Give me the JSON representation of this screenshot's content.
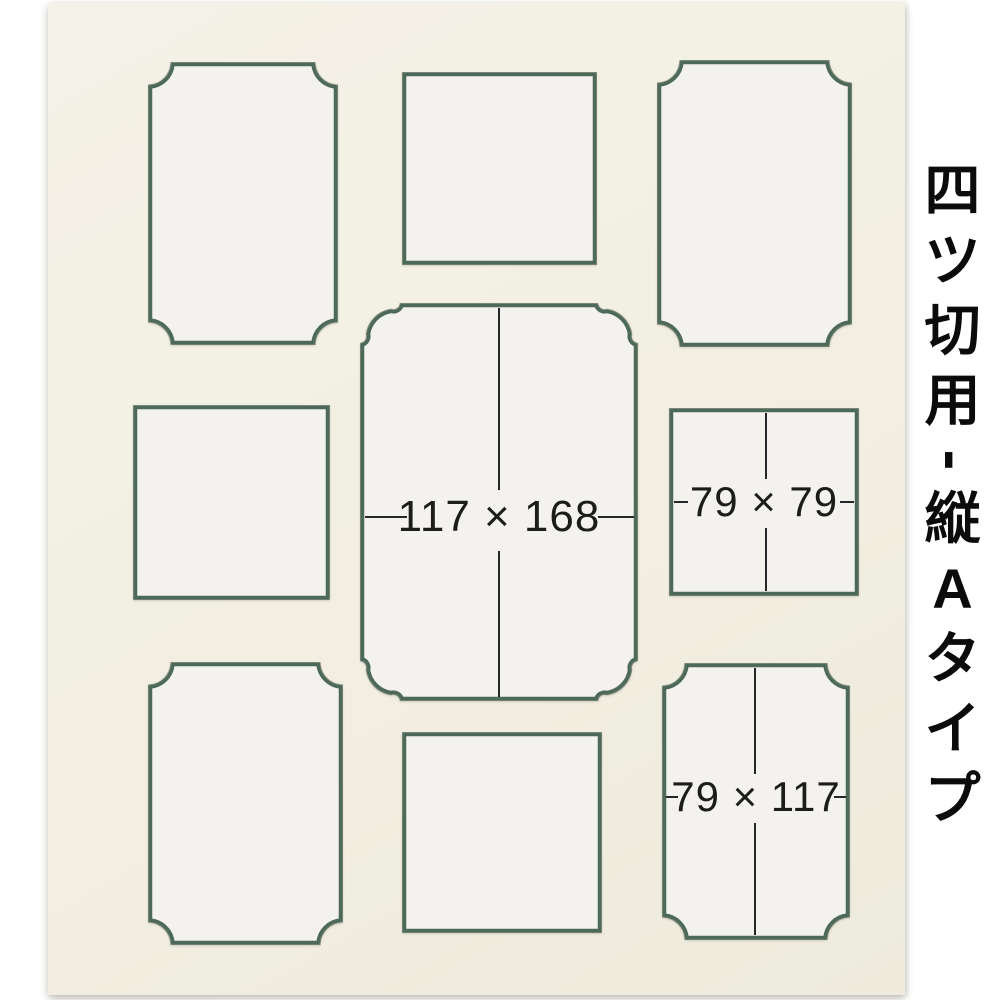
{
  "page": {
    "background": "#ffffff"
  },
  "product": {
    "description": "multi-window photo mat board, cream with dark green bevel core",
    "mat_color": "#f2efe2",
    "core_color": "#4d6a59",
    "opening_fill": "#f4f2ee",
    "dimension_line_color": "#26262a",
    "side_label": {
      "text": "四ツ切用-縦Aタイプ",
      "chars": [
        "四",
        "ツ",
        "切",
        "用",
        "-",
        "縦",
        "A",
        "タ",
        "イ",
        "プ"
      ]
    }
  },
  "openings": [
    {
      "position": "top-left",
      "corner_style": "notched",
      "label": ""
    },
    {
      "position": "top-center",
      "corner_style": "square",
      "label": ""
    },
    {
      "position": "top-right",
      "corner_style": "notched",
      "label": ""
    },
    {
      "position": "middle-left",
      "corner_style": "square",
      "label": ""
    },
    {
      "position": "center",
      "corner_style": "decorative-rounded",
      "label": "117 × 168"
    },
    {
      "position": "middle-right",
      "corner_style": "square",
      "label": "79 × 79"
    },
    {
      "position": "bottom-left",
      "corner_style": "notched",
      "label": ""
    },
    {
      "position": "bottom-center",
      "corner_style": "square",
      "label": ""
    },
    {
      "position": "bottom-right",
      "corner_style": "notched",
      "label": "79 × 117"
    }
  ]
}
